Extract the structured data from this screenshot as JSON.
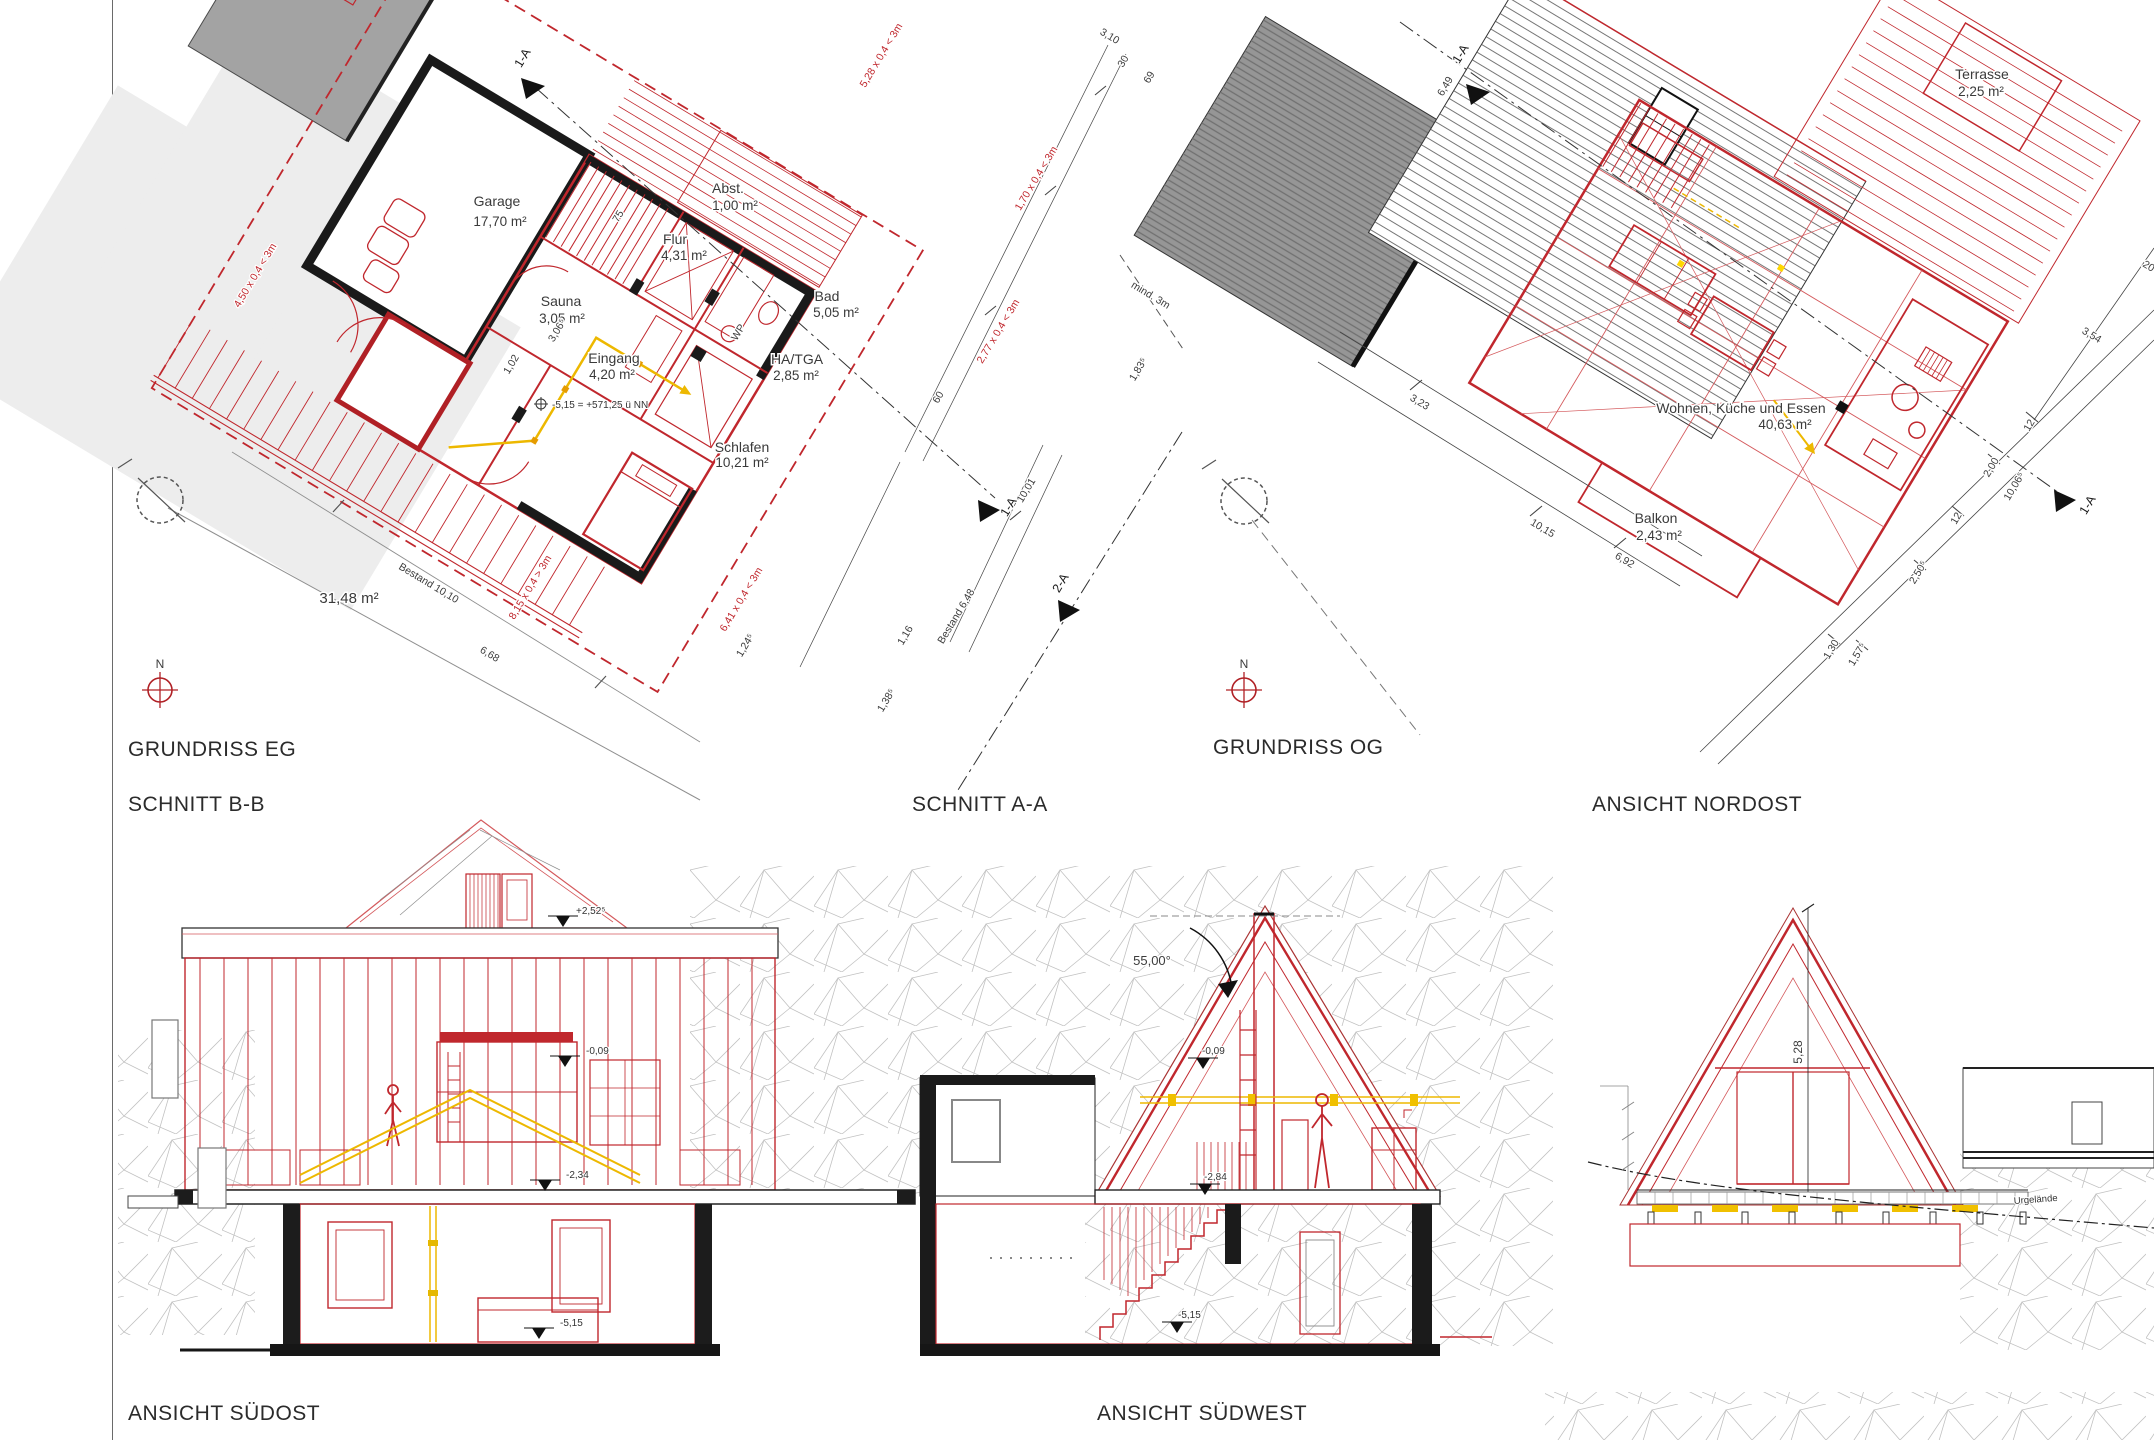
{
  "titles": {
    "grundriss_eg": "GRUNDRISS EG",
    "schnitt_bb": "SCHNITT B-B",
    "grundriss_og": "GRUNDRISS OG",
    "schnitt_aa": "SCHNITT A-A",
    "ansicht_nordost": "ANSICHT NORDOST",
    "ansicht_suedost": "ANSICHT SÜDOST",
    "ansicht_suedwest": "ANSICHT SÜDWEST"
  },
  "plan_eg": {
    "north": "N",
    "site_area": "31,48 m²",
    "rooms": [
      {
        "name": "Garage",
        "area": "17,70 m²"
      },
      {
        "name": "Flur",
        "area": "4,31 m²"
      },
      {
        "name": "Abst.",
        "area": "1,00 m²"
      },
      {
        "name": "Bad",
        "area": "5,05 m²"
      },
      {
        "name": "Sauna",
        "area": "3,05 m²"
      },
      {
        "name": "Eingang",
        "area": "4,20 m²"
      },
      {
        "name": "HA/TGA",
        "area": "2,85 m²"
      },
      {
        "name": "Schlafen",
        "area": "10,21 m²"
      }
    ],
    "dims": {
      "bestand1010": "Bestand 10,10",
      "d668": "6,68",
      "red815": "8,15 x 0,4 > 3m",
      "red450": "4,50 x 0,4 < 3m",
      "red641": "6,41 x 0,4 < 3m",
      "red528": "5,28 x 0,4 < 3m",
      "red170": "1,70 x 0,4 < 3m",
      "red277": "2,77 x 0,4 < 3m",
      "mind3m": "mind. 3m",
      "d310": "3,10",
      "d30": "30",
      "d69": "69",
      "d183": "1,83⁵",
      "d60": "60",
      "d1001": "10,01",
      "bestand648": "Bestand 6,48",
      "d116": "1,16",
      "d138": "1,38⁵",
      "d124": "1,24⁵",
      "d102": "1,02",
      "d75": "75",
      "d306": "3,06⁵",
      "wp": "WP",
      "level": "-5,15 = +571,25 ü NN"
    },
    "markers": {
      "a1_top": "1-A",
      "a1_right": "1-A",
      "a2": "2-A"
    }
  },
  "plan_og": {
    "north": "N",
    "rooms": [
      {
        "name": "Terrasse",
        "area": "2,25 m²"
      },
      {
        "name": "Wohnen, Küche und Essen",
        "area": "40,63 m²"
      },
      {
        "name": "Balkon",
        "area": "2,43 m²"
      }
    ],
    "dims": {
      "d323": "3,23",
      "d1015": "10,15",
      "d692": "6,92",
      "d130": "1,30",
      "d157": "1,57⁵",
      "d250": "2,50⁵",
      "d12a": "12",
      "d200": "2,00",
      "d1006": "10,06⁵",
      "d12b": "12",
      "d354": "3,54",
      "d20": "20",
      "d649": "6,49"
    },
    "markers": {
      "a1_top": "1-A",
      "a1_right": "1-A"
    }
  },
  "schnitt_bb": {
    "levels": {
      "eaves": "+2,52⁵",
      "og_floor": "-0,09",
      "eg_floor": "-2,34",
      "ug_floor": "-5,15"
    }
  },
  "schnitt_aa": {
    "roof_angle": "55,00°",
    "levels": {
      "og_floor": "-0,09",
      "eg_floor": "-2,84",
      "ug_floor": "-5,15"
    }
  },
  "ansicht_no": {
    "height": "5,28",
    "terrain": "Urgelände"
  }
}
